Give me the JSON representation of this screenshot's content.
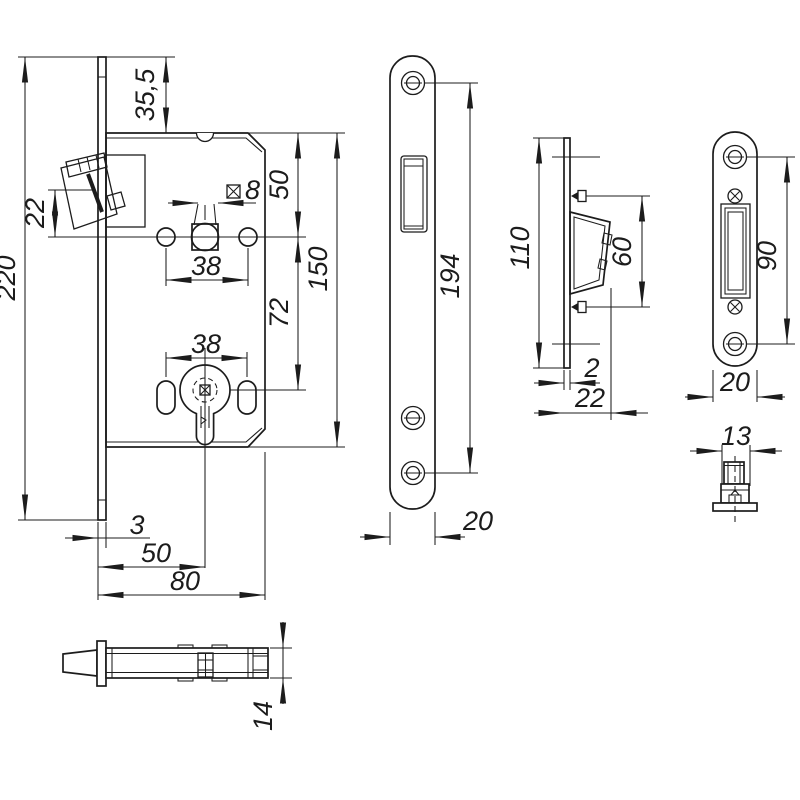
{
  "colors": {
    "background": "#ffffff",
    "line": "#1c1c1c"
  },
  "views": {
    "lock_body_front": {
      "dims": {
        "overall_height": "220",
        "faceplate_overhang": "35,5",
        "latch_height": "22",
        "spindle_square_size": "8",
        "handle_hole_spacing": "38",
        "edge_to_spindle": "50",
        "spindle_to_cylinder": "72",
        "body_height": "150",
        "cylinder_hole_spacing": "38",
        "faceplate_thickness": "3",
        "backset": "50",
        "body_depth": "80"
      }
    },
    "lock_body_bottom": {
      "dims": {
        "body_thickness": "14"
      }
    },
    "faceplate_front": {
      "dims": {
        "screw_hole_spacing": "194",
        "plate_width": "20"
      }
    },
    "strike_plate_side": {
      "dims": {
        "plate_height": "110",
        "screw_spacing": "60",
        "plate_thickness": "2",
        "overall_depth": "22"
      }
    },
    "strike_plate_front": {
      "dims": {
        "screw_hole_spacing": "90",
        "plate_width": "20"
      }
    },
    "latch_bolt_top": {
      "dims": {
        "latch_width": "13"
      }
    }
  }
}
